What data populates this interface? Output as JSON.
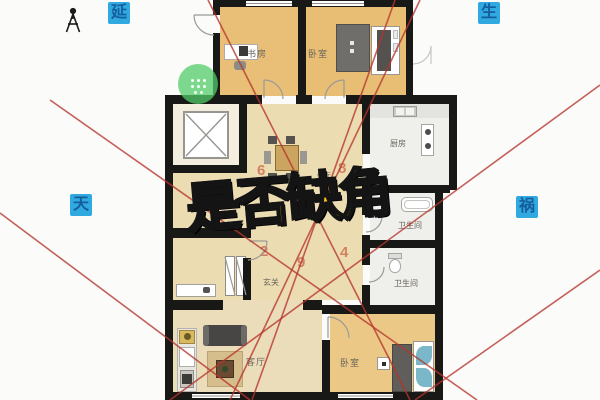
{
  "title_overlay": {
    "text": "是否缺角",
    "color": "#f4c319"
  },
  "direction_badges": [
    {
      "id": "yan",
      "text": "延"
    },
    {
      "id": "sheng",
      "text": "生"
    },
    {
      "id": "tian",
      "text": "天"
    },
    {
      "id": "huo",
      "text": "祸"
    }
  ],
  "badge_bg": "#2fa9e0",
  "sector_numbers": [
    {
      "value": "6"
    },
    {
      "value": "8"
    },
    {
      "value": "2"
    },
    {
      "value": "9"
    },
    {
      "value": "4"
    }
  ],
  "rooms": [
    {
      "id": "study",
      "label": "书房"
    },
    {
      "id": "bedroom-top",
      "label": "卧室"
    },
    {
      "id": "kitchen",
      "label": "厨房"
    },
    {
      "id": "dining",
      "label": "餐厅"
    },
    {
      "id": "bathroom-upper",
      "label": "卫生间"
    },
    {
      "id": "bathroom-lower",
      "label": "卫生间"
    },
    {
      "id": "entry",
      "label": "玄关"
    },
    {
      "id": "living",
      "label": "客厅"
    },
    {
      "id": "bedroom-bottom",
      "label": "卧室"
    }
  ],
  "icons": {
    "person_marker": "person-icon",
    "drag_handle": "move-icon",
    "elevator_cross": "x-box-icon"
  },
  "colors": {
    "wall": "#181816",
    "red_line": "#b5352b",
    "wood_floor": "#e9bf77",
    "pale_floor": "#ecdcb2",
    "tile_floor": "#eff0ec",
    "accent_green": "#52cc68"
  }
}
